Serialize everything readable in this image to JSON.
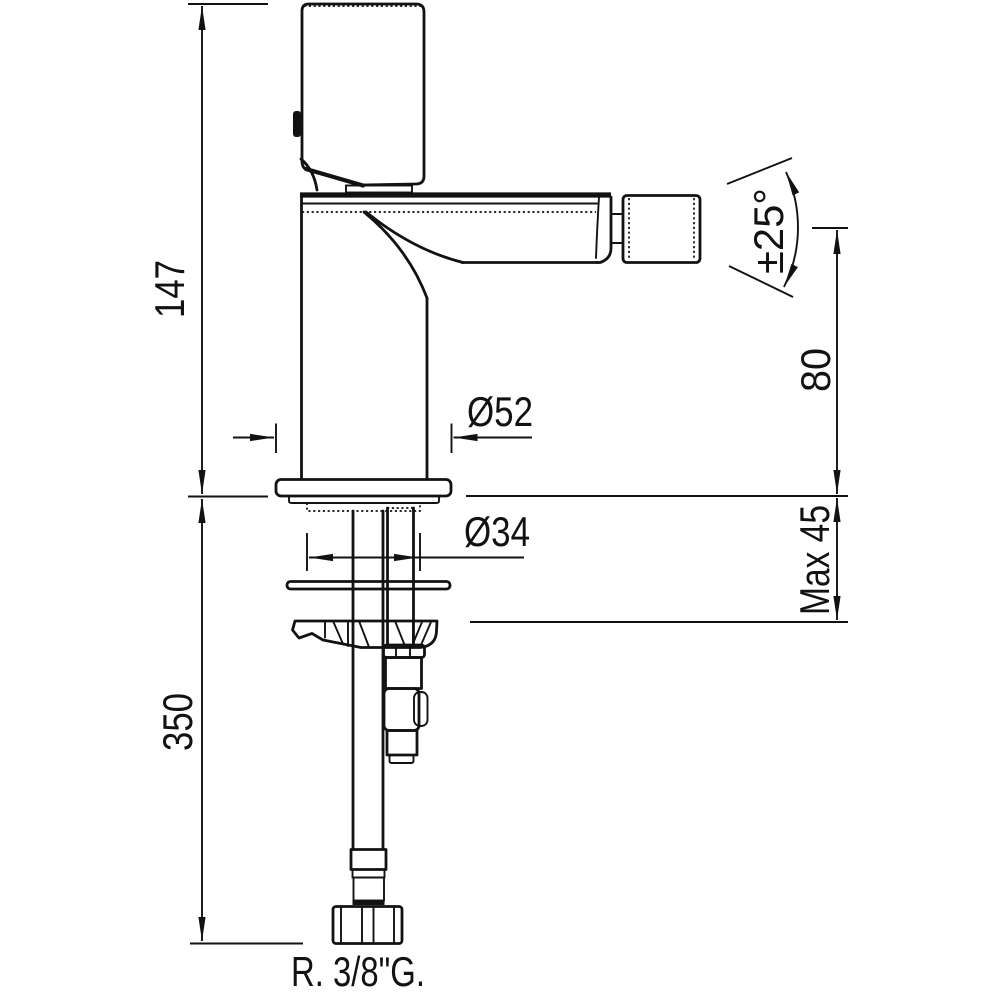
{
  "drawing": {
    "background_color": "#ffffff",
    "line_color": "#121212",
    "labels": {
      "total_height": "147",
      "hose_length": "350",
      "base_diameter": "Ø52",
      "shank_diameter": "Ø34",
      "spout_height": "80",
      "max_deck_thickness": "Max 45",
      "swivel_angle": "±25°",
      "thread_size": "R. 3/8\"G."
    }
  }
}
